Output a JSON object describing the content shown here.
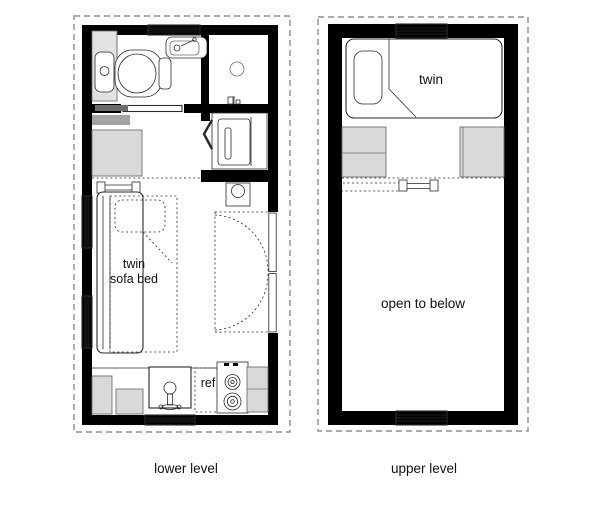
{
  "colors": {
    "background": "#ffffff",
    "wall": "#000000",
    "line": "#2a2a2a",
    "line_soft": "#6f6f6f",
    "gray_light": "#d9d9d9",
    "gray_mid": "#a3a3a3",
    "gray_dark": "#6b6b6b",
    "dashed_border": "#8f8f8f"
  },
  "lower_level": {
    "caption": "lower level",
    "labels": {
      "sofa_line1": "twin",
      "sofa_line2": "sofa bed",
      "refrigerator": "ref"
    }
  },
  "upper_level": {
    "caption": "upper level",
    "labels": {
      "bed": "twin",
      "open": "open to below"
    }
  }
}
